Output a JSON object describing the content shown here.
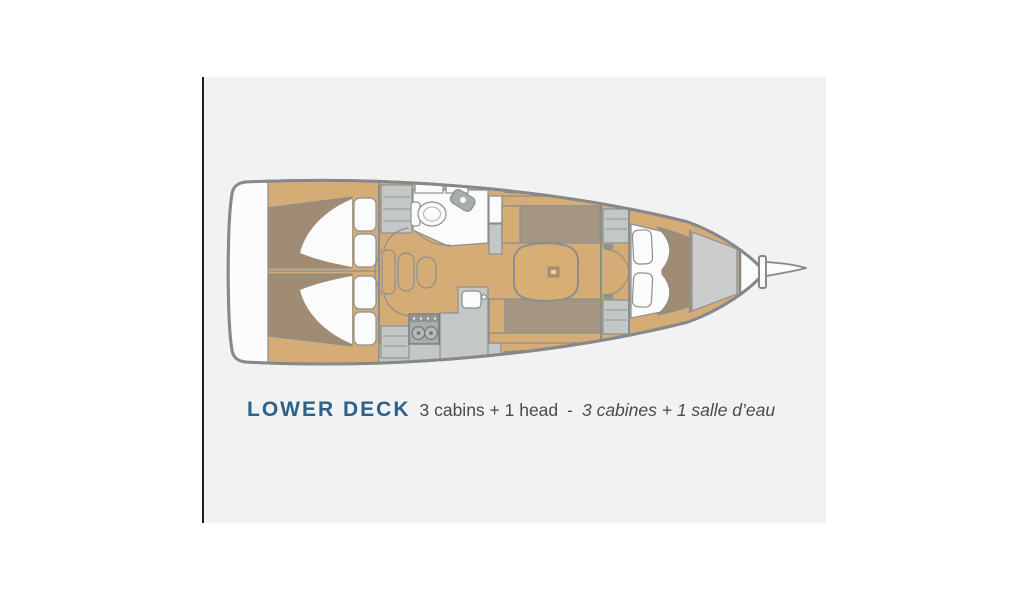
{
  "page": {
    "background": "#ffffff"
  },
  "panel": {
    "background": "#f2f2f3",
    "edge_color": "#1f1f1f"
  },
  "caption": {
    "title": "LOWER DECK",
    "spec_en": "3 cabins + 1 head",
    "separator": "-",
    "spec_fr": "3 cabines + 1 salle d’eau",
    "title_color": "#2e6188",
    "text_color": "#4b4b4b"
  },
  "plan": {
    "colors": {
      "hull_outline": "#85898c",
      "line": "#8b8e90",
      "wood": "#d5ac75",
      "wood_dark": "#b5905e",
      "mattress": "#a08b74",
      "upholstery": "#a59681",
      "counter": "#c3c7c6",
      "counter_dark": "#8e9393",
      "appliance": "#a7acac",
      "white_fill": "#fbfbfb",
      "locker": "#cbcdcc"
    }
  }
}
